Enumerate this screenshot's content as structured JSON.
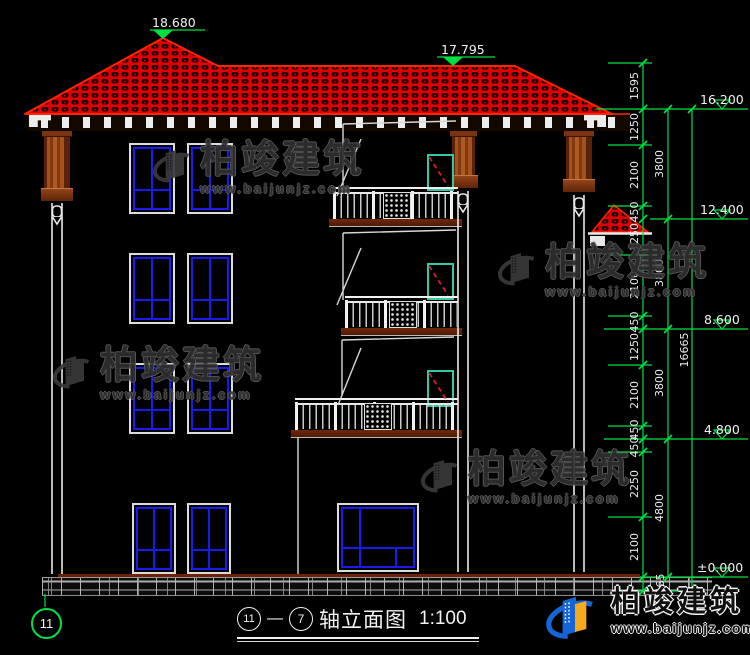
{
  "drawing": {
    "top_markers": [
      {
        "value": "18.680"
      },
      {
        "value": "17.795"
      }
    ],
    "elevation_markers": [
      {
        "value": "16.200"
      },
      {
        "value": "12.400"
      },
      {
        "value": "8.600"
      },
      {
        "value": "4.800"
      },
      {
        "value": "±0.000"
      }
    ],
    "dims": {
      "chain1": [
        "1595",
        "1250",
        "2100",
        "450",
        "1250",
        "2100",
        "450",
        "1250",
        "2100",
        "450",
        "450",
        "2250",
        "2100",
        "465"
      ],
      "chain2": [
        "3800",
        "3800",
        "3800",
        "4800"
      ],
      "total": "16665"
    },
    "axis_bubble": "11",
    "title": {
      "axis_a": "11",
      "axis_b": "7",
      "name": "轴立面图",
      "scale": "1:100"
    },
    "watermark": {
      "brand": "柏竣建筑",
      "url": "www.baijunjz.com"
    },
    "footer": {
      "brand": "柏竣建筑",
      "url": "www.baijunjz.com"
    },
    "colors": {
      "cad_green": "#00e040",
      "roof_red": "#dd0000",
      "window_blue": "#1a1af0",
      "door_teal": "#35c8a4",
      "column_brown": "#83380f",
      "logo_blue": "#1565d8",
      "logo_orange": "#f7a81d"
    }
  }
}
